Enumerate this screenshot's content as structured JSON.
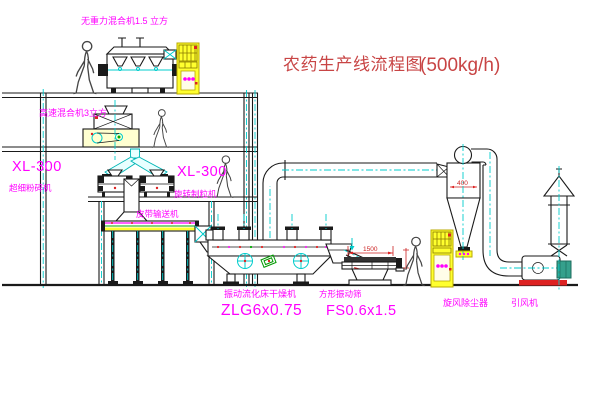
{
  "title": {
    "name": "农药生产线流程图",
    "capacity": "(500kg/h)"
  },
  "equipment_labels": {
    "gravity_free_mixer": "无重力混合机1.5 立方",
    "high_speed_mixer": "高速混合机3立方",
    "pulverizer_model": "XL-300",
    "pulverizer": "超细粉碎机",
    "granulator_model": "XL-300",
    "granulator": "旋转制粒机",
    "belt_conveyor": "皮带输送机",
    "fluid_bed_dryer": "振动流化床干燥机",
    "fluid_bed_dryer_model": "ZLG6x0.75",
    "square_sieve": "方形振动筛",
    "square_sieve_model": "FS0.6x1.5",
    "cyclone": "旋风除尘器",
    "induced_draft_fan": "引风机"
  },
  "dimensions": {
    "sieve_length": "1500",
    "cyclone_body": "400"
  },
  "colors": {
    "label_magenta": "#ff00ff",
    "title_red": "#c84545",
    "dimension_red": "#cc2222",
    "equipment_yellow": "#ffff2e",
    "centerline_cyan": "#00cccc",
    "line_black": "#1a1a1a",
    "motor_green": "#35a08c",
    "base_red": "#dd2222"
  }
}
